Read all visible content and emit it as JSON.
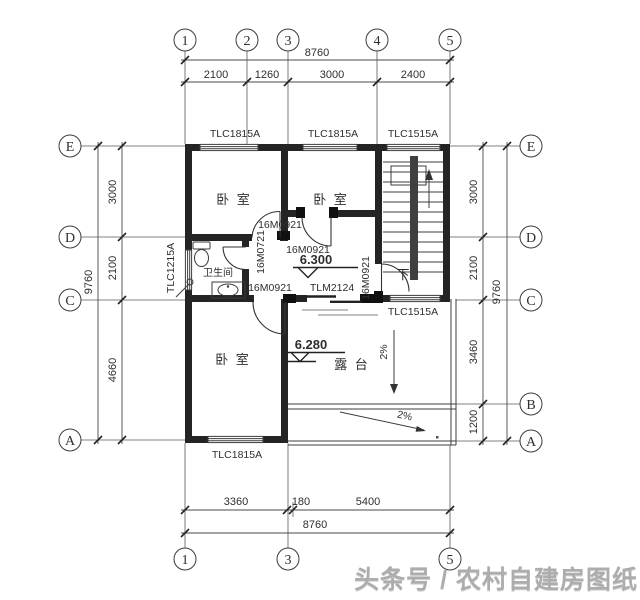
{
  "axes": {
    "top": [
      "1",
      "2",
      "3",
      "4",
      "5"
    ],
    "bottom": [
      "1",
      "3",
      "5"
    ],
    "left": [
      "E",
      "D",
      "C",
      "A"
    ],
    "right": [
      "E",
      "D",
      "C",
      "B",
      "A"
    ]
  },
  "dims": {
    "top_overall": "8760",
    "top_segments": [
      "2100",
      "1260",
      "3000",
      "2400"
    ],
    "bottom_overall": "8760",
    "bottom_segments": [
      "3360",
      "180",
      "5400"
    ],
    "left_overall": "9760",
    "left_segments": [
      "3000",
      "2100",
      "4660"
    ],
    "right_overall": "9760",
    "right_segments": [
      "3000",
      "2100",
      "3460",
      "1200"
    ]
  },
  "rooms": {
    "bedroom1": "卧 室",
    "bedroom2": "卧 室",
    "bedroom3": "卧 室",
    "bathroom": "卫生间",
    "terrace": "露 台",
    "stair_down": "下"
  },
  "windows": {
    "top_left": "TLC1815A",
    "top_mid": "TLC1815A",
    "top_right": "TLC1515A",
    "left": "TLC1215A",
    "bottom": "TLC1815A",
    "stair_south": "TLC1515A"
  },
  "doors": {
    "bedroom1": "16M0921",
    "bedroom2": "16M0921",
    "bathroom": "16M0721",
    "bedroom3": "16M0921",
    "stairwell": "16M0921",
    "terrace": "TLM2124"
  },
  "elevations": {
    "hall": "6.300",
    "terrace": "6.280"
  },
  "slopes": {
    "terrace": "2%",
    "apron": "2%"
  },
  "watermark": "头条号 / 农村自建房图纸",
  "colors": {
    "line": "#2e2e2e",
    "watermark": "#a5a5a5",
    "paper": "#ffffff"
  }
}
